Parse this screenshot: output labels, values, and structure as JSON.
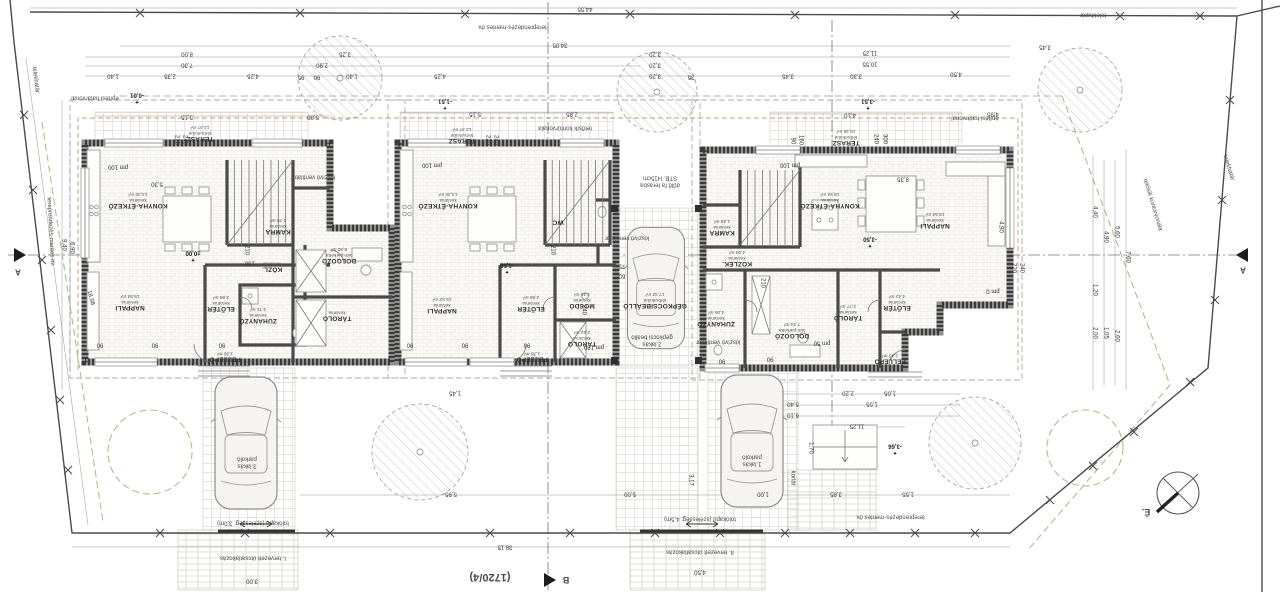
{
  "site": {
    "lot_number": "(1720/4)",
    "north_label": "É.",
    "boundary_label": "telekhatár"
  },
  "houses": [
    {
      "id": "house-1",
      "rooms": [
        {
          "n": "TERASZ",
          "f": "térburkolat",
          "a": "12,47 m²",
          "x": 200,
          "y": 133
        },
        {
          "n": "KONYHA-ÉTKEZŐ",
          "f": "kerámia",
          "a": "13,30 m²",
          "x": 138,
          "y": 200
        },
        {
          "n": "NAPPALI",
          "f": "kerámia",
          "a": "15,54 m²",
          "x": 130,
          "y": 302
        },
        {
          "n": "KAMRA",
          "f": "kerámia",
          "a": "1,70 m²",
          "x": 278,
          "y": 226
        },
        {
          "n": "KÖZL.",
          "f": "kerámia",
          "x": 272,
          "y": 266
        },
        {
          "n": "DOLGOZÓ",
          "f": "lam.parketta",
          "a": "8,30 m²",
          "x": 339,
          "y": 255
        },
        {
          "n": "ZUHANYZÓ",
          "f": "kerámia",
          "a": "3,71 m²",
          "x": 258,
          "y": 315
        },
        {
          "n": "ELŐTÉR",
          "f": "kerámia",
          "a": "3,88 m²",
          "x": 221,
          "y": 303
        },
        {
          "n": "TÁROLÓ",
          "f": "kerámia",
          "x": 337,
          "y": 315
        },
        {
          "n": "FELLÉPŐ",
          "a": "1,35 m²",
          "x": 225,
          "y": 356
        }
      ]
    },
    {
      "id": "house-2",
      "rooms": [
        {
          "n": "TERASZ",
          "f": "térburkolat",
          "a": "12,47 m²",
          "x": 462,
          "y": 135
        },
        {
          "n": "KONYHA-ÉTKEZŐ",
          "f": "kerámia",
          "a": "13,30 m²",
          "x": 448,
          "y": 200
        },
        {
          "n": "NAPPALI",
          "f": "kerámia",
          "a": "15,52 m²",
          "x": 442,
          "y": 305
        },
        {
          "n": "WC",
          "x": 558,
          "y": 222
        },
        {
          "n": "MOSDÓ",
          "f": "kerámia",
          "a": "1,40 m²",
          "x": 582,
          "y": 300
        },
        {
          "n": "TÁROLÓ",
          "f": "kerámia",
          "a": "2,52 m²",
          "x": 582,
          "y": 338
        },
        {
          "n": "ELŐTÉR",
          "f": "kerámia",
          "a": "3,56 m²",
          "x": 531,
          "y": 303
        },
        {
          "n": "FELLÉPŐ",
          "a": "1,35 m²",
          "x": 532,
          "y": 356
        },
        {
          "n": "GÉPKOCSIBEÁLLÓ",
          "f": "térburkolat",
          "a": "17,42 m²",
          "x": 655,
          "y": 300
        }
      ]
    },
    {
      "id": "house-3",
      "rooms": [
        {
          "n": "TERASZ",
          "f": "térburkolat",
          "a": "15,25 m²",
          "x": 846,
          "y": 137
        },
        {
          "n": "KONYHA-ÉTKEZŐ",
          "f": "kerámia",
          "a": "18,54 m²",
          "x": 830,
          "y": 200
        },
        {
          "n": "NAPPALI",
          "f": "kerámia",
          "a": "18,54 m²",
          "x": 935,
          "y": 220
        },
        {
          "n": "KAMRA",
          "f": "kerámia",
          "a": "1,48 m²",
          "x": 722,
          "y": 227
        },
        {
          "n": "KÖZLEK.",
          "f": "kerámia",
          "a": "4,00 m²",
          "x": 737,
          "y": 258
        },
        {
          "n": "ZUHANYZÓ",
          "f": "kerámia",
          "a": "4,06 m²",
          "x": 716,
          "y": 318
        },
        {
          "n": "DOLGOZÓ",
          "f": "lam.parketta",
          "a": "7,34 m²",
          "x": 792,
          "y": 330
        },
        {
          "n": "TÁROLÓ",
          "f": "kerámia",
          "a": "3,77 m²",
          "x": 848,
          "y": 312
        },
        {
          "n": "ELŐTÉR",
          "f": "kerámia",
          "a": "4,42 m²",
          "x": 897,
          "y": 302
        },
        {
          "n": "FELLÉPŐ",
          "a": "2,45 m²",
          "x": 890,
          "y": 358
        }
      ]
    }
  ],
  "elevations": [
    {
      "t": "±0,00",
      "x": 193,
      "y": 256
    },
    {
      "t": "-1,50",
      "x": 507,
      "y": 268
    },
    {
      "t": "-3,50",
      "x": 870,
      "y": 242
    },
    {
      "t": "-0,01",
      "x": 137,
      "y": 98
    },
    {
      "t": "-1,51",
      "x": 445,
      "y": 104
    },
    {
      "t": "-3,51",
      "x": 868,
      "y": 104
    },
    {
      "t": "-3,66",
      "x": 895,
      "y": 449
    }
  ],
  "annotations": [
    {
      "t": "telekhatár",
      "x": 35,
      "y": 80,
      "r": 83
    },
    {
      "t": "telekhatár",
      "x": 1093,
      "y": 14
    },
    {
      "t": "telekhatár",
      "x": 1228,
      "y": 168,
      "r": 73
    },
    {
      "t": "tereprendezés-mentes öv.",
      "x": 512,
      "y": 26
    },
    {
      "t": "tereprendezés-mentes öv.",
      "x": 890,
      "y": 516
    },
    {
      "t": "tereprendezés-mentes öv.",
      "x": 50,
      "y": 232,
      "r": 87
    },
    {
      "t": "építési határvonal",
      "x": 95,
      "y": 97
    },
    {
      "t": "építési határvonal",
      "x": 975,
      "y": 117
    },
    {
      "t": "tetősík kontúrvonala",
      "x": 565,
      "y": 127
    },
    {
      "t": "tetősík kontúrvonala",
      "x": 1152,
      "y": 205,
      "r": 73
    },
    {
      "t": "kiszívó ventilátor",
      "x": 313,
      "y": 176
    },
    {
      "t": "kiszívó ventilátor",
      "x": 627,
      "y": 237
    },
    {
      "t": "kiszívó ventilátor",
      "x": 718,
      "y": 341
    },
    {
      "t": "dűlő fa terasba",
      "t2": "STB. H15cm",
      "x": 660,
      "y": 181
    },
    {
      "t": "tolókapu (szélesség: 3,0m)",
      "x": 253,
      "y": 522
    },
    {
      "t": "tolókapu (szélesség: 4,5m)",
      "x": 700,
      "y": 518
    },
    {
      "t": "I. tervezett útcsatlakozás",
      "x": 253,
      "y": 557
    },
    {
      "t": "II. tervezett útcsatlakozás",
      "x": 700,
      "y": 551
    },
    {
      "t": "3.lakás",
      "t2": "parkoló",
      "x": 247,
      "y": 462
    },
    {
      "t": "1.lakás",
      "t2": "parkoló",
      "x": 752,
      "y": 460
    },
    {
      "t": "2.lakás",
      "t2": "gépkocsi beálló",
      "x": 652,
      "y": 340
    },
    {
      "t": "korlát",
      "x": 792,
      "y": 478,
      "r": 90
    },
    {
      "t": "(1720/4)",
      "x": 490,
      "y": 577,
      "s": 11,
      "b": 1,
      "dn": "lot-number-label"
    },
    {
      "t": "É.",
      "x": 1146,
      "y": 512,
      "s": 9,
      "b": 1,
      "dn": "north-label"
    },
    {
      "t": "A",
      "x": 18,
      "y": 271,
      "s": 8,
      "b": 1,
      "dn": "section-marker-a-left-label"
    },
    {
      "t": "A",
      "x": 1243,
      "y": 269,
      "s": 8,
      "b": 1,
      "dn": "section-marker-a-right-label"
    },
    {
      "t": "B",
      "x": 566,
      "y": 580,
      "s": 9,
      "b": 1,
      "dn": "section-marker-b-label"
    }
  ],
  "dimensions": [
    {
      "t": "44,55",
      "x": 585,
      "y": 8
    },
    {
      "t": "34,05",
      "x": 560,
      "y": 44
    },
    {
      "t": "11,25",
      "x": 870,
      "y": 52
    },
    {
      "t": "10,55",
      "x": 870,
      "y": 63
    },
    {
      "t": "8,00",
      "x": 187,
      "y": 53
    },
    {
      "t": "3,25",
      "x": 345,
      "y": 53
    },
    {
      "t": "3,20",
      "x": 655,
      "y": 53
    },
    {
      "t": "7,30",
      "x": 187,
      "y": 64
    },
    {
      "t": "2,90",
      "x": 322,
      "y": 64
    },
    {
      "t": "3,20",
      "x": 655,
      "y": 64
    },
    {
      "t": "1,40",
      "x": 113,
      "y": 75
    },
    {
      "t": "2,35",
      "x": 170,
      "y": 75
    },
    {
      "t": "4,25",
      "x": 253,
      "y": 75
    },
    {
      "t": "95",
      "x": 301,
      "y": 76
    },
    {
      "t": "90",
      "x": 317,
      "y": 76
    },
    {
      "t": "1,40",
      "x": 352,
      "y": 75
    },
    {
      "t": "4,25",
      "x": 440,
      "y": 75
    },
    {
      "t": "3,20",
      "x": 655,
      "y": 75
    },
    {
      "t": "35",
      "x": 691,
      "y": 76
    },
    {
      "t": "3,45",
      "x": 788,
      "y": 75
    },
    {
      "t": "3,30",
      "x": 856,
      "y": 75
    },
    {
      "t": "4,50",
      "x": 956,
      "y": 73
    },
    {
      "t": "3,45",
      "x": 1045,
      "y": 46
    },
    {
      "t": "5,15",
      "x": 187,
      "y": 116
    },
    {
      "t": "5,80",
      "x": 313,
      "y": 116
    },
    {
      "t": "5,15",
      "x": 475,
      "y": 113
    },
    {
      "t": "2,85",
      "x": 572,
      "y": 113
    },
    {
      "t": "4,10",
      "x": 850,
      "y": 114
    },
    {
      "t": "4,95",
      "x": 993,
      "y": 113
    },
    {
      "t": "8,35",
      "x": 903,
      "y": 178
    },
    {
      "t": "5,30",
      "x": 157,
      "y": 183
    },
    {
      "t": "9,40",
      "x": 63,
      "y": 245,
      "r": 90
    },
    {
      "t": "6,90",
      "x": 71,
      "y": 248,
      "r": 90
    },
    {
      "t": "18,98",
      "x": 90,
      "y": 298,
      "r": 75
    },
    {
      "t": "4,40",
      "x": 1094,
      "y": 212,
      "r": 90
    },
    {
      "t": "4,90",
      "x": 1105,
      "y": 237,
      "r": 90
    },
    {
      "t": "5,60",
      "x": 1116,
      "y": 232,
      "r": 90
    },
    {
      "t": "7,60",
      "x": 1127,
      "y": 257,
      "r": 90
    },
    {
      "t": "1,20",
      "x": 1094,
      "y": 290,
      "r": 90
    },
    {
      "t": "2,00",
      "x": 1094,
      "y": 333,
      "r": 90
    },
    {
      "t": "1,05",
      "x": 1105,
      "y": 333,
      "r": 90
    },
    {
      "t": "2,60",
      "x": 1116,
      "y": 336,
      "r": 90
    },
    {
      "t": "4,90",
      "x": 1000,
      "y": 227,
      "r": 90
    },
    {
      "t": "1,45",
      "x": 455,
      "y": 392
    },
    {
      "t": "2,20",
      "x": 848,
      "y": 392
    },
    {
      "t": "1,05",
      "x": 890,
      "y": 392
    },
    {
      "t": "1,55",
      "x": 872,
      "y": 403
    },
    {
      "t": "5,40",
      "x": 793,
      "y": 403
    },
    {
      "t": "6,10",
      "x": 793,
      "y": 414
    },
    {
      "t": "11,25",
      "x": 857,
      "y": 425
    },
    {
      "t": "1,70",
      "x": 810,
      "y": 448,
      "r": 90
    },
    {
      "t": "3,85",
      "x": 836,
      "y": 493
    },
    {
      "t": "1,55",
      "x": 908,
      "y": 493
    },
    {
      "t": "5,95",
      "x": 451,
      "y": 493
    },
    {
      "t": "5,00",
      "x": 630,
      "y": 493
    },
    {
      "t": "1,00",
      "x": 763,
      "y": 493
    },
    {
      "t": "3,17",
      "x": 690,
      "y": 480,
      "r": 90
    },
    {
      "t": "38,15",
      "x": 505,
      "y": 546
    },
    {
      "t": "3,00",
      "x": 252,
      "y": 580
    },
    {
      "t": "4,50",
      "x": 700,
      "y": 571
    },
    {
      "t": "pm 100",
      "x": 118,
      "y": 166
    },
    {
      "t": "pm 100",
      "x": 432,
      "y": 164
    },
    {
      "t": "pm 100",
      "x": 790,
      "y": 164
    },
    {
      "t": "pm 180",
      "x": 594,
      "y": 346
    },
    {
      "t": "pm 50",
      "x": 822,
      "y": 342
    },
    {
      "t": "pm 0",
      "x": 993,
      "y": 290
    },
    {
      "t": "220",
      "x": 176,
      "y": 140,
      "r": 90
    },
    {
      "t": "240",
      "x": 184,
      "y": 140,
      "r": 90
    },
    {
      "t": "220",
      "x": 487,
      "y": 140,
      "r": 90
    },
    {
      "t": "240",
      "x": 495,
      "y": 140,
      "r": 90
    },
    {
      "t": "240",
      "x": 875,
      "y": 139,
      "r": 90
    },
    {
      "t": "300",
      "x": 884,
      "y": 139,
      "r": 90
    },
    {
      "t": "160",
      "x": 800,
      "y": 140,
      "r": 90
    },
    {
      "t": "90",
      "x": 792,
      "y": 141,
      "r": 90
    },
    {
      "t": "220",
      "x": 1013,
      "y": 268,
      "r": 90
    },
    {
      "t": "240",
      "x": 1021,
      "y": 268,
      "r": 90
    },
    {
      "t": "90",
      "x": 100,
      "y": 344
    },
    {
      "t": "90",
      "x": 155,
      "y": 344
    },
    {
      "t": "90",
      "x": 222,
      "y": 344
    },
    {
      "t": "90",
      "x": 410,
      "y": 344
    },
    {
      "t": "90",
      "x": 465,
      "y": 344
    },
    {
      "t": "90",
      "x": 527,
      "y": 344
    },
    {
      "t": "90",
      "x": 722,
      "y": 360
    },
    {
      "t": "90",
      "x": 770,
      "y": 358
    },
    {
      "t": "210",
      "x": 246,
      "y": 250,
      "r": 90
    },
    {
      "t": "130",
      "x": 250,
      "y": 262
    },
    {
      "t": "210",
      "x": 552,
      "y": 250,
      "r": 90
    },
    {
      "t": "210",
      "x": 762,
      "y": 283,
      "r": 90
    },
    {
      "t": "240",
      "x": 583,
      "y": 310,
      "r": 90
    },
    {
      "t": "75",
      "x": 622,
      "y": 265
    },
    {
      "t": "60",
      "x": 622,
      "y": 275
    }
  ]
}
